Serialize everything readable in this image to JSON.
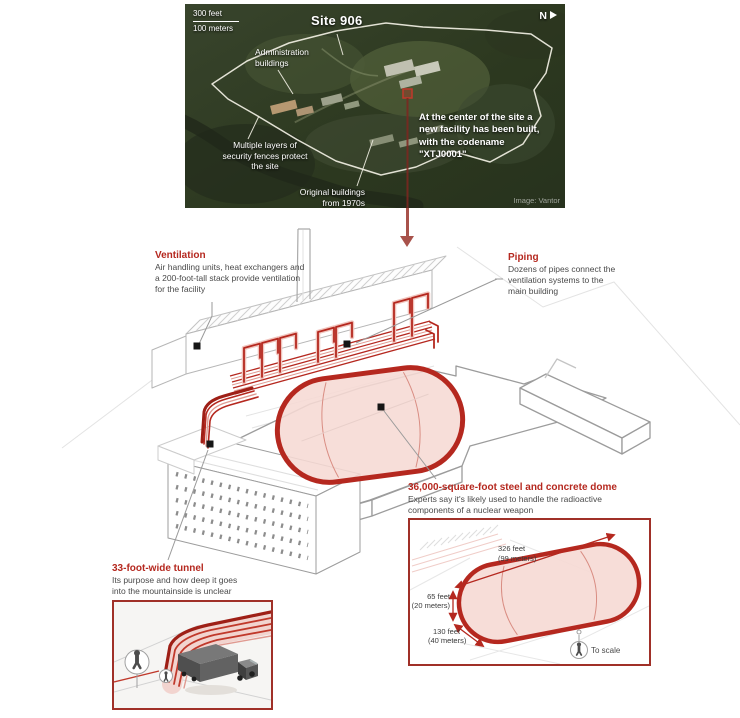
{
  "colors": {
    "accent_red": "#b5281f",
    "pipe_red": "#c0392b",
    "dome_fill": "#f6d9d4",
    "inset_border": "#a03028",
    "marker_black": "#161616",
    "leader_gray": "#9a9a9a",
    "outline_gray": "#9c9c9c",
    "fence_white": "#f2f0e4",
    "arrow_maroon": "#a8524b"
  },
  "icons": {
    "north_arrow_icon": "right-triangle",
    "person_icon": "standing-figure",
    "truck_icon": "box-truck",
    "site_marker_icon": "red-square"
  },
  "satellite": {
    "scale_feet": "300 feet",
    "scale_meters": "100 meters",
    "title": "Site 906",
    "north": "N",
    "admin_label": "Administration buildings",
    "fences_label": "Multiple layers of security fences protect the site",
    "original_label": "Original buildings from 1970s",
    "center_lines": [
      "At the center of the site a",
      "new facility has been built,",
      "with the codename",
      "\"XTJ0001\""
    ],
    "credit": "Image: Vantor"
  },
  "callouts": {
    "ventilation": {
      "title": "Ventilation",
      "body": "Air handling units, heat exchangers and a 200-foot-tall stack provide ventilation for the facility"
    },
    "piping": {
      "title": "Piping",
      "body": "Dozens of pipes connect the ventilation systems to the main building"
    },
    "dome": {
      "title": "36,000-square-foot steel and concrete dome",
      "body": "Experts say it's likely used to handle the radioactive components of a nuclear weapon"
    },
    "tunnel": {
      "title": "33-foot-wide tunnel",
      "body": "Its purpose and how deep it goes into the mountainside is unclear"
    }
  },
  "scale_inset": {
    "length_ft": "326 feet",
    "length_m": "(99 meters)",
    "height_ft": "65 feet",
    "height_m": "(20 meters)",
    "width_ft": "130 feet",
    "width_m": "(40 meters)",
    "to_scale": "To scale"
  }
}
